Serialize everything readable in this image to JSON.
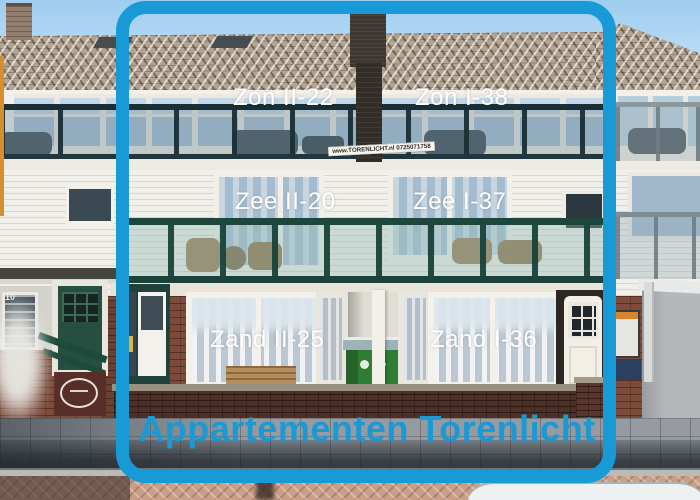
{
  "image": {
    "alt": "Street-level photo of the three-storey Torenlicht apartment building with a blue rounded frame overlay labelling each apartment",
    "frame_color": "#189ad6"
  },
  "overlay": {
    "title": "Appartementen Torenlicht",
    "banner": "www.TORENLICHT.nl  0725071758",
    "labels": [
      {
        "id": "zon-ii",
        "floor": "top",
        "text": "Zon II-22"
      },
      {
        "id": "zon-i",
        "floor": "top",
        "text": "Zon I-38"
      },
      {
        "id": "zee-ii",
        "floor": "middle",
        "text": "Zee II-20"
      },
      {
        "id": "zee-i",
        "floor": "middle",
        "text": "Zee I-37"
      },
      {
        "id": "zand-ii",
        "floor": "ground",
        "text": "Zand II-25"
      },
      {
        "id": "zand-i",
        "floor": "ground",
        "text": "Zand I-36"
      }
    ]
  },
  "details": {
    "house_number": "10"
  },
  "colors": {
    "frame_blue": "#189ad6",
    "title_blue": "#1a99d5",
    "label_text": "#ffffff",
    "sky": "#aed5f0",
    "roof_tile": "#b3a492",
    "balcony_railing_green": "#1d463c",
    "ground_brick": "#7d4b3a",
    "bin_green": "#2f7d33",
    "pavement_pink": "#c99f87"
  }
}
